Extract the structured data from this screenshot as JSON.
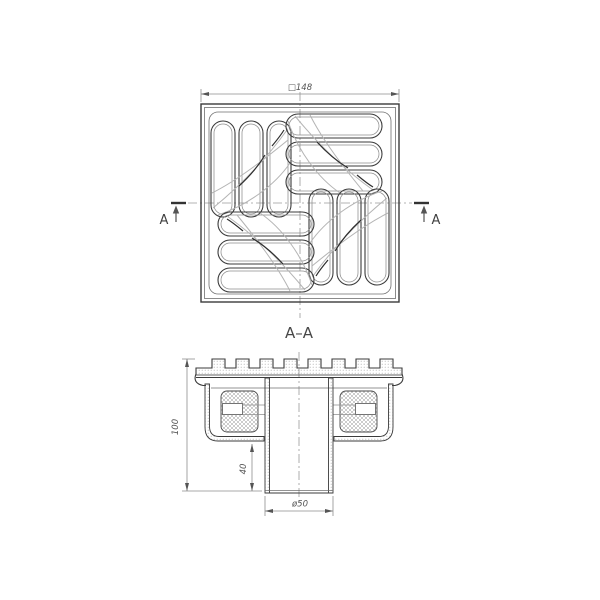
{
  "labels": {
    "overall_square_dim": "□148",
    "section_cut_left": "A",
    "section_cut_right": "A",
    "section_title": "A–A",
    "height_dim": "100",
    "spigot_length_dim": "40",
    "spigot_diameter_dim": "ø50"
  },
  "colors": {
    "background": "#ffffff",
    "line_dark": "#3b3b3b",
    "line_medium": "#6f6f6f",
    "swirl_light": "#b4b4b4",
    "dimension": "#8d8d8d",
    "centerline": "#9a9a9a"
  }
}
